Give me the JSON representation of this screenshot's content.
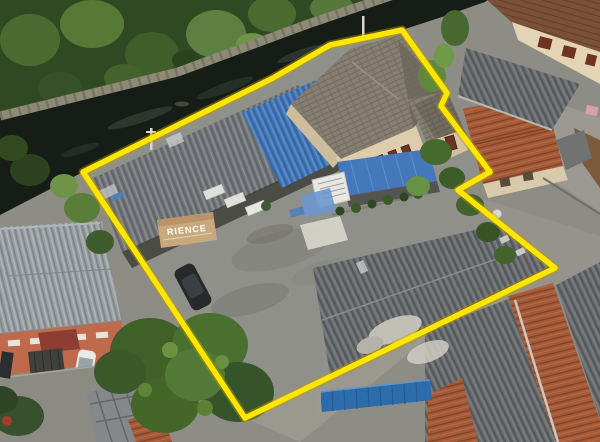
{
  "image": {
    "kind": "aerial-drone-photograph",
    "description": "Bird's-eye view of a residential property outlined with a bright yellow boundary. A dark canal with a concrete retaining wall and dense tropical trees border the upper-left; inside the boundary are a two-story cream house with gray shingle roof and blue awning, a gray corrugated workshop roof, a blue corrugated roof, a concrete courtyard with a parked dark car, and a large corrugated warehouse roof; neighboring terracotta-roof houses, a salmon townhouse, streets and trees surround it.",
    "width": 600,
    "height": 442
  },
  "boundary": {
    "label": "property-boundary-highlight",
    "color": "#ffe600",
    "halo_color": "#b89b00",
    "stroke_width": "5.5",
    "halo_width": "9",
    "points": "83,172 273,78 330,45 402,30 447,93 441,106 490,172 458,190 555,268 245,418"
  },
  "sign": {
    "text": "RIENCE",
    "text_color": "#ffffff",
    "awning_color": "#c9a97c"
  },
  "colors": {
    "base_ground": "#8d8d86",
    "courtyard": "#90908a",
    "street": "#8b8b83",
    "canal_water": "#161d16",
    "canal_wall": "#8d8a76",
    "veg_dark": "#2f4a22",
    "workshop_roof": "#75787a",
    "blue_roof": "#4679b8",
    "awning_blue": "#4478ba",
    "house_roof": "#857e71",
    "house_wall": "#ddcdad",
    "window_red": "#6e3322",
    "warehouse_roof": "#6b6e70",
    "terracotta": "#a25a38",
    "brown_tile": "#7a5138",
    "townhouse_roof": "#9aa0a3",
    "townhouse_wall": "#bf6a4c",
    "gate_blue": "#2d6cab",
    "car_dark": "#26292c",
    "car_white": "#e9eae6",
    "tree_green": "#4a7030"
  }
}
